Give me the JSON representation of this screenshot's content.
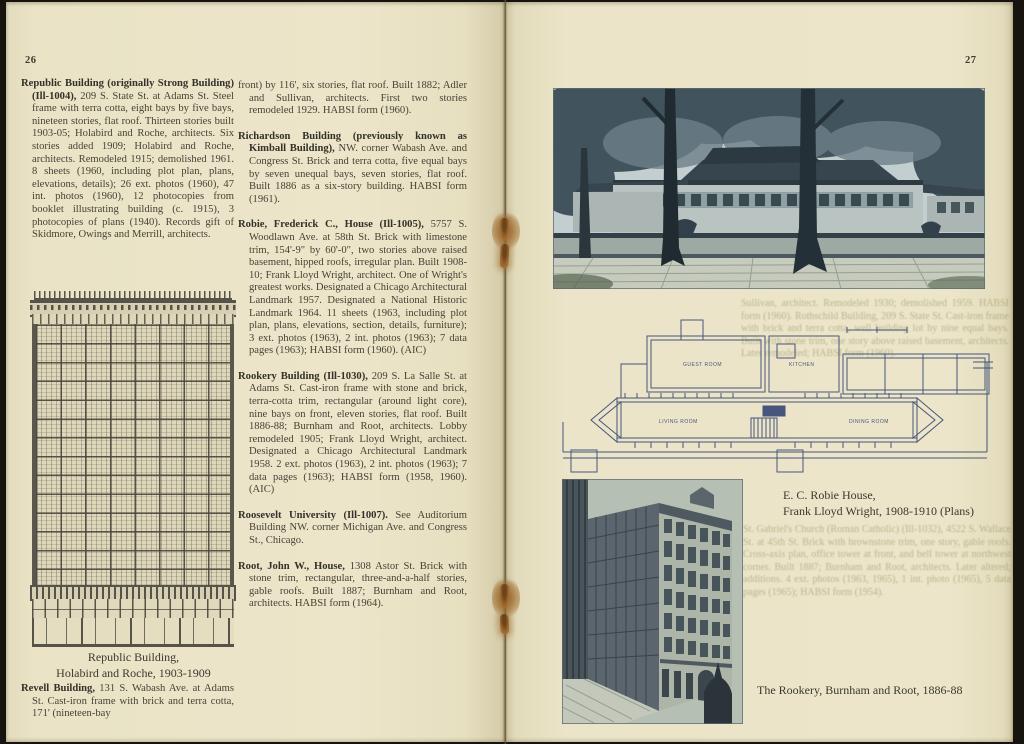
{
  "colors": {
    "paper": "#ece5c9",
    "ink": "#44423a",
    "photo_dark": "#2e3c45",
    "photo_light": "#c7d1d1",
    "plan_ink": "#44547a",
    "staple_rust": "#9a662e"
  },
  "left": {
    "page_number": "26",
    "republic_head": "Republic Building (originally Strong Building) (Ill-1004),",
    "republic_body": " 209 S. State St. at Adams St. Steel frame with terra cotta, eight bays by five bays, nineteen stories, flat roof. Thirteen stories built 1903-05; Holabird and Roche, architects. Six stories added 1909; Holabird and Roche, architects. Remodeled 1915; demolished 1961. 8 sheets (1960, including plot plan, plans, elevations, details); 26 ext. photos (1960), 47 int. photos (1960), 12 photocopies from booklet illustrating building (c. 1915), 3 photocopies of plans (1940). Records gift of Skidmore, Owings and Merrill, architects.",
    "drawing_caption_1": "Republic Building,",
    "drawing_caption_2": "Holabird and Roche, 1903-1909",
    "revell_head": "Revell Building,",
    "revell_body": " 131 S. Wabash Ave. at Adams St. Cast-iron frame with brick and terra cotta, 171' (nineteen-bay",
    "entries": [
      {
        "head": "",
        "body": "front) by 116', six stories, flat roof. Built 1882; Adler and Sullivan, architects. First two stories remodeled 1929. HABSI form (1960)."
      },
      {
        "head": "Richardson Building (previously known as Kimball Building),",
        "body": " NW. corner Wabash Ave. and Congress St. Brick and terra cotta, five equal bays by seven unequal bays, seven stories, flat roof. Built 1886 as a six-story building. HABSI form (1961)."
      },
      {
        "head": "Robie, Frederick C., House (Ill-1005),",
        "body": " 5757 S. Woodlawn Ave. at 58th St. Brick with limestone trim, 154'-9\" by 60'-0\", two stories above raised basement, hipped roofs, irregular plan. Built 1908-10; Frank Lloyd Wright, architect. One of Wright's greatest works. Designated a Chicago Architectural Landmark 1957. Designated a National Historic Landmark 1964. 11 sheets (1963, including plot plan, plans, elevations, section, details, furniture); 3 ext. photos (1963), 2 int. photos (1963); 7 data pages (1963); HABSI form (1960). (AIC)"
      },
      {
        "head": "Rookery Building (Ill-1030),",
        "body": " 209 S. La Salle St. at Adams St. Cast-iron frame with stone and brick, terra-cotta trim, rectangular (around light core), nine bays on front, eleven stories, flat roof. Built 1886-88; Burnham and Root, architects. Lobby remodeled 1905; Frank Lloyd Wright, architect. Designated a Chicago Architectural Landmark 1958. 2 ext. photos (1963), 2 int. photos (1963); 7 data pages (1963); HABSI form (1958, 1960). (AIC)"
      },
      {
        "head": "Roosevelt University (Ill-1007).",
        "body": " See Auditorium Building NW. corner Michigan Ave. and Congress St., Chicago."
      },
      {
        "head": "Root, John W., House,",
        "body": " 1308 Astor St. Brick with stone trim, rectangular, three-and-a-half stories, gable roofs. Built 1887; Burnham and Root, architects. HABSI form (1964)."
      }
    ]
  },
  "right": {
    "page_number": "27",
    "robie_caption_1": "E. C. Robie House,",
    "robie_caption_2": "Frank Lloyd Wright, 1908-1910 (Plans)",
    "rookery_caption": "The Rookery, Burnham and Root, 1886-88",
    "plan_labels": {
      "guest": "GUEST ROOM",
      "kitchen": "KITCHEN",
      "living": "LIVING ROOM",
      "dining": "DINING ROOM"
    },
    "bleed_1": "Sullivan, architect. Remodeled 1930; demolished 1959. HABSI form (1960). Rothschild Building, 209 S. State St. Cast-iron frame with brick and terra cotta, well building lot by nine equal bays. Built with stone trim, one story above raised basement, architects. Later remodeled; HABSI form (1960).",
    "bleed_2": "St. Gabriel's Church (Roman Catholic) (Ill-1032), 4522 S. Wallace St. at 45th St. Brick with brownstone trim, one story, gable roofs. Cross-axis plan, office tower at front, and bell tower at northwest corner. Built 1887; Burnham and Root, architects. Later altered; additions. 4 ext. photos (1963, 1965), 1 int. photo (1965), 5 data pages (1965); HABSI form (1954)."
  }
}
